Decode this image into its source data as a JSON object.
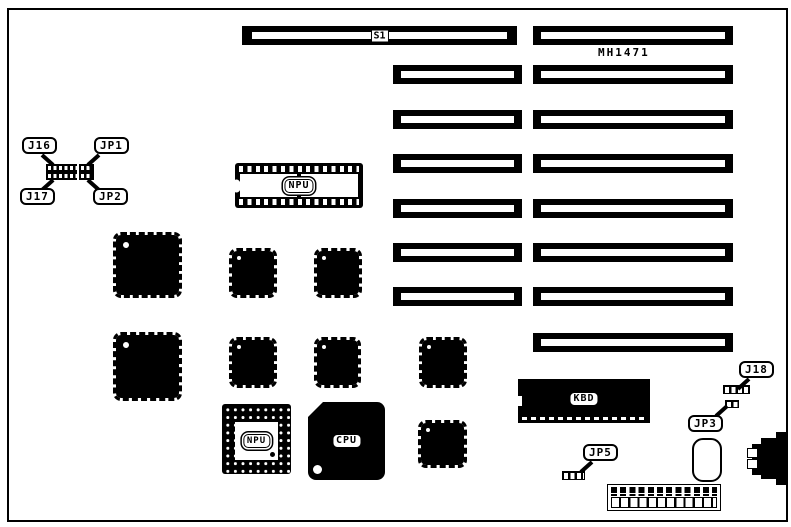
{
  "board": {
    "part_number": "MH1471",
    "labels": {
      "s1": "S1",
      "j16": "J16",
      "jp1": "JP1",
      "j17": "J17",
      "jp2": "JP2",
      "npu_dip": "NPU",
      "npu_pga": "NPU",
      "cpu": "CPU",
      "kbd": "KBD",
      "j18": "J18",
      "jp3": "JP3",
      "jp5": "JP5"
    },
    "colors": {
      "ink": "#000000",
      "paper": "#ffffff"
    }
  }
}
